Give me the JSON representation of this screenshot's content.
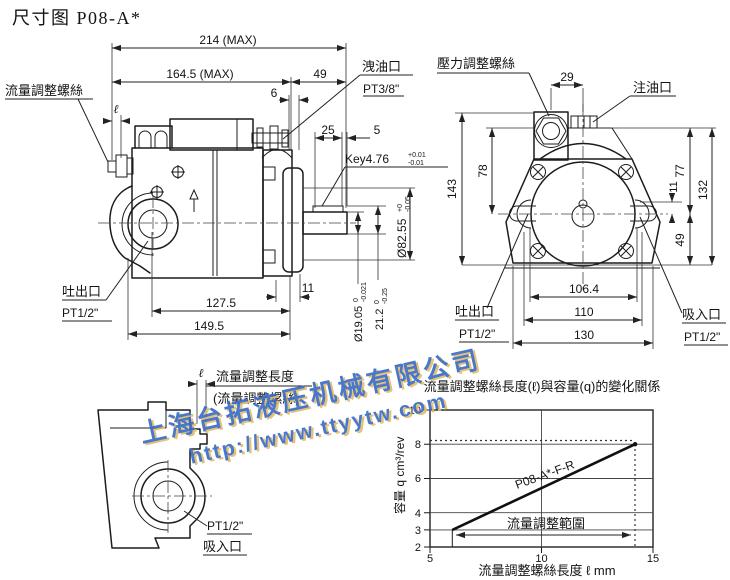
{
  "title": "尺寸图 P08-A*",
  "side_view": {
    "flow_screw_label": "流量調整螺絲",
    "ell": "ℓ",
    "dim_overall": "214 (MAX)",
    "dim_body": "164.5 (MAX)",
    "dim_rear": "49",
    "dim_6": "6",
    "drain_port_label": "洩油口",
    "drain_port_size": "PT3/8\"",
    "dim_25": "25",
    "dim_5": "5",
    "key_label": "Key4.76",
    "key_tol_plus": "+0.01",
    "key_tol_minus": "-0.01",
    "pilot_dia": "Ø82.55",
    "pilot_tol_plus": "+0",
    "pilot_tol_minus": "-0.05",
    "outlet_label": "吐出口",
    "outlet_size": "PT1/2\"",
    "dim_127_5": "127.5",
    "dim_149_5": "149.5",
    "dim_11": "11",
    "shaft_dia": "Ø19.05",
    "shaft_tol_plus": "0",
    "shaft_tol_minus": "-0.021",
    "key_height": "21.2",
    "key_height_tol_plus": "0",
    "key_height_tol_minus": "-0.25"
  },
  "front_view": {
    "pressure_screw_label": "壓力調整螺絲",
    "oil_fill_label": "注油口",
    "dim_29": "29",
    "dim_78": "78",
    "dim_143": "143",
    "dim_11": "11",
    "dim_77": "77",
    "dim_132": "132",
    "dim_49": "49",
    "dim_106_4": "106.4",
    "dim_110": "110",
    "dim_130": "130",
    "outlet_label": "吐出口",
    "outlet_size": "PT1/2\"",
    "inlet_label": "吸入口",
    "inlet_size": "PT1/2\""
  },
  "detail_view": {
    "ell": "ℓ",
    "adjust_length_label": "流量調整長度",
    "adjust_screw_label": "(流量調整螺絲)",
    "inlet_size": "PT1/2\"",
    "inlet_label": "吸入口"
  },
  "watermark": {
    "company": "上海台拓液压机械有限公司",
    "url": "http://www.ttyytw.com",
    "color": "#3a6cc8",
    "shadow_color": "#e2bd6d"
  },
  "chart_data": {
    "type": "line",
    "title": "流量調整螺絲長度(ℓ)與容量(q)的變化關係",
    "xlabel": "流量調整螺絲長度 ℓ mm",
    "ylabel": "容量 q cm³/rev",
    "xlim": [
      5,
      15
    ],
    "ylim": [
      2,
      10
    ],
    "x_ticks": [
      5,
      10,
      15
    ],
    "y_ticks": [
      2,
      3,
      4,
      6,
      8,
      10
    ],
    "grid": true,
    "legend_position": "on-line",
    "series": [
      {
        "name": "P08-A*-F-R",
        "x": [
          6,
          14.2
        ],
        "y": [
          3,
          8
        ]
      }
    ],
    "annotations": [
      {
        "type": "range-arrow",
        "text": "流量調整範圍",
        "x_from": 6,
        "x_to": 14.2,
        "y": 2.7
      },
      {
        "type": "dashed-max-line",
        "y": 8,
        "x_to": 14.2
      }
    ]
  }
}
